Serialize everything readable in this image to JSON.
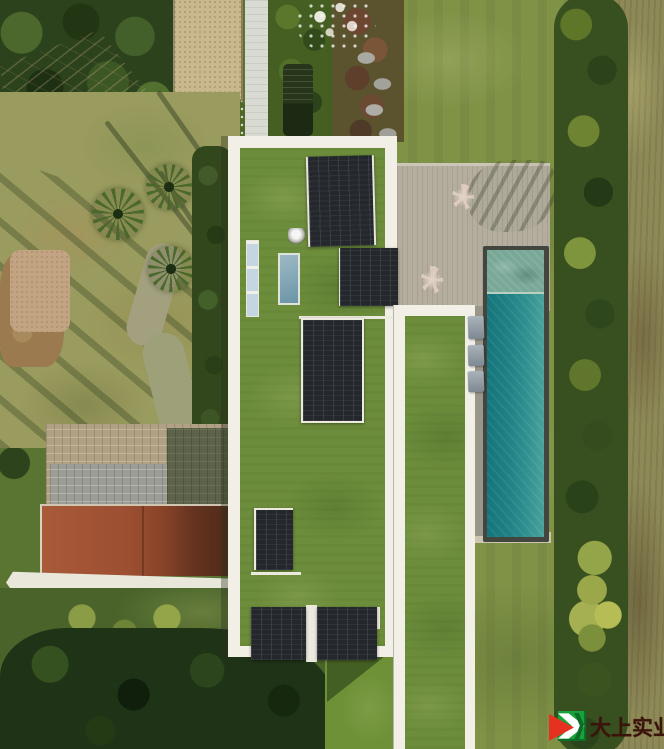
{
  "scene": {
    "alt": "Aerial drone view of a modern house with two offset green-grass flat roofs edged in white, rooftop solar panels and skylights, a wooden pool deck with a long turquoise lap pool and loungers, lawns, a gravel court, a paved driveway, a terracotta-roofed outbuilding, hedges, palm trees and dense gardens."
  },
  "watermark": {
    "text": "大上实业",
    "text_color": "#3a140a",
    "logo": {
      "green": "#17a23b",
      "red": "#e63121",
      "chevron": "#ffffff",
      "dark_vein": "#0c6b24"
    }
  },
  "colors": {
    "roof-grass": "#6c8d3b",
    "roof-border": "#f1efe6",
    "panel-dark": "#24272b",
    "deck": "#b5ae9f",
    "pool-deep": "#15757b",
    "pool-mid": "#2f9190",
    "pool-light": "#4aa29b",
    "pool-shallow": "#79a898",
    "coping": "#43463f",
    "lawn-olive": "#7f9246",
    "lawn-pale": "#9a9b5e",
    "hedge-dark": "#384f20",
    "field": "#8e8a58",
    "trees-dark": "#2c421c",
    "trees-deep": "#1f3317",
    "gravel": "#c9b78d",
    "path-white": "#d9dad2",
    "driveway-tan": "#b0a084",
    "driveway-gray": "#9c9d95",
    "wall-white": "#e9e6da",
    "skylight-blue": "#b6cbd9",
    "skylight-teal": "#7fa4b4",
    "dirt": "#9b7a4f",
    "wm-green": "#17a23b",
    "wm-red": "#e63121",
    "wm-text": "#3a140a"
  }
}
